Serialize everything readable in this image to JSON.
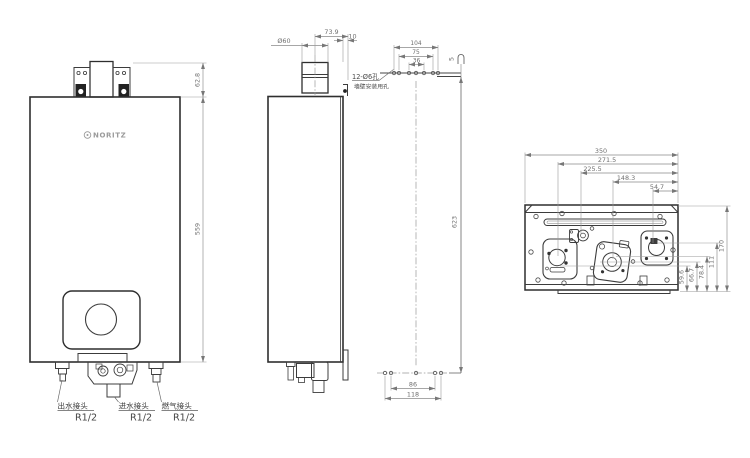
{
  "front_view": {
    "brand": "NORITZ",
    "dim_bracket_height": "62.8",
    "dim_body_height": "559",
    "connections": [
      {
        "label": "出水接头",
        "thread": "R1/2"
      },
      {
        "label": "进水接头",
        "thread": "R1/2"
      },
      {
        "label": "燃气接头",
        "thread": "R1/2"
      }
    ]
  },
  "side_view": {
    "dim_flue_diameter": "Ø60",
    "dim_flue_center_to_back": "73.9",
    "dim_back_clearance": "10"
  },
  "mounting_view": {
    "dim_top_holes_outer": "104",
    "dim_top_holes_mid": "75",
    "dim_top_holes_inner": "36",
    "holes_note": "12-Ø6孔",
    "holes_note_sub": "墙壁安装用孔",
    "dim_bracket_gap": "5",
    "dim_hole_rows_spacing": "623",
    "dim_bottom_holes_inner": "86",
    "dim_bottom_holes_outer": "118"
  },
  "bottom_view": {
    "dim_width": "350",
    "dim_h1": "271.5",
    "dim_h2": "225.5",
    "dim_h3": "148.3",
    "dim_h4": "54.7",
    "dim_v1": "59.6",
    "dim_v2": "66.7",
    "dim_v3": "78.4",
    "dim_v4": "111",
    "dim_v5": "170"
  }
}
